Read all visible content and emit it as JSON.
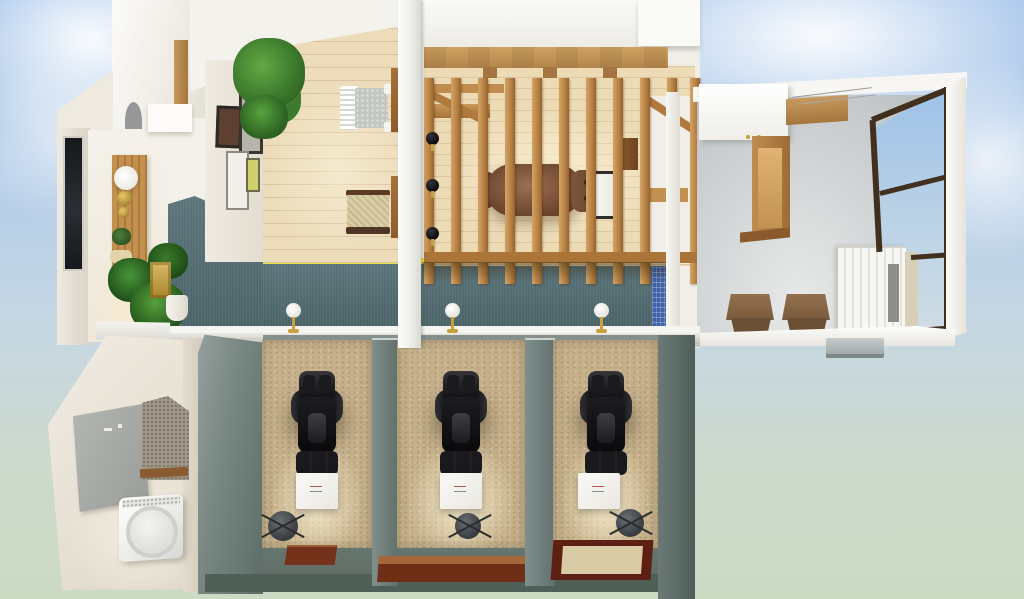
{
  "scene": {
    "title": "3D bird's-eye floor plan render of a salon and spa interior",
    "view": "top-down 3D perspective, building floating on sky backdrop",
    "background": "sky gradient with soft clouds"
  },
  "palette": {
    "sky_top": "#9fc0ea",
    "sky_bottom": "#ccdac4",
    "wall_white": "#f3f1ea",
    "wall_cream": "#ece6d8",
    "teal_carpet": "#536d72",
    "mosaic_blue": "#4062a8",
    "accent_yellow": "#e8e243",
    "wood_floor": "#ecdcba",
    "wood_beam": "#c59a5d",
    "gray_floor": "#ced2d4",
    "booth_wall": "#76857f",
    "booth_wall_dark": "#5d6c66",
    "carpet_tan": "#c5b08a",
    "chair_black": "#141416",
    "recliner_brown": "#7c543c",
    "chair_brown": "#8a684a",
    "mat_brown": "#74321b",
    "mat_inner": "#d8cba6",
    "gold": "#c8a13c",
    "window_frame": "#42301f",
    "board_gray": "#a7aaa8",
    "speckle_wall": "#a0988a",
    "appliance_white": "#f4f4f2"
  },
  "rooms": [
    {
      "id": "entry",
      "label": "Entrance / reception",
      "items": [
        "dark glass door",
        "wooden console",
        "globe lamp",
        "brass spheres",
        "potted plants",
        "brass side table",
        "white planter",
        "arched mirror",
        "white shelf"
      ]
    },
    {
      "id": "lounge",
      "label": "Waiting lounge",
      "items": [
        "light wood plank floor",
        "gallery wall with four frames",
        "large potted plant",
        "white wicker chair",
        "rattan armchair",
        "yellow floor trim"
      ]
    },
    {
      "id": "treatment-room",
      "label": "Private treatment room",
      "items": [
        "timber slat partition",
        "ceiling beam",
        "leather recliner chair",
        "white side bench",
        "three black wall sconces",
        "blue mosaic tile strip"
      ]
    },
    {
      "id": "back-room",
      "label": "Back room with corner window",
      "items": [
        "gray tile floor",
        "white overhead cabinet",
        "wooden wall counter",
        "two brown lounge chairs",
        "white slatted cabinet",
        "dark-framed corner window",
        "outdoor AC unit"
      ]
    },
    {
      "id": "utility",
      "label": "Utility room",
      "items": [
        "gray wall board",
        "textured accent wall",
        "front-load washing machine"
      ]
    },
    {
      "id": "booths",
      "label": "Treatment booths",
      "count": 3,
      "items": [
        "black massage chair",
        "white side table",
        "rolling stool",
        "wooden mat",
        "brass table lamp on ledge"
      ]
    }
  ]
}
